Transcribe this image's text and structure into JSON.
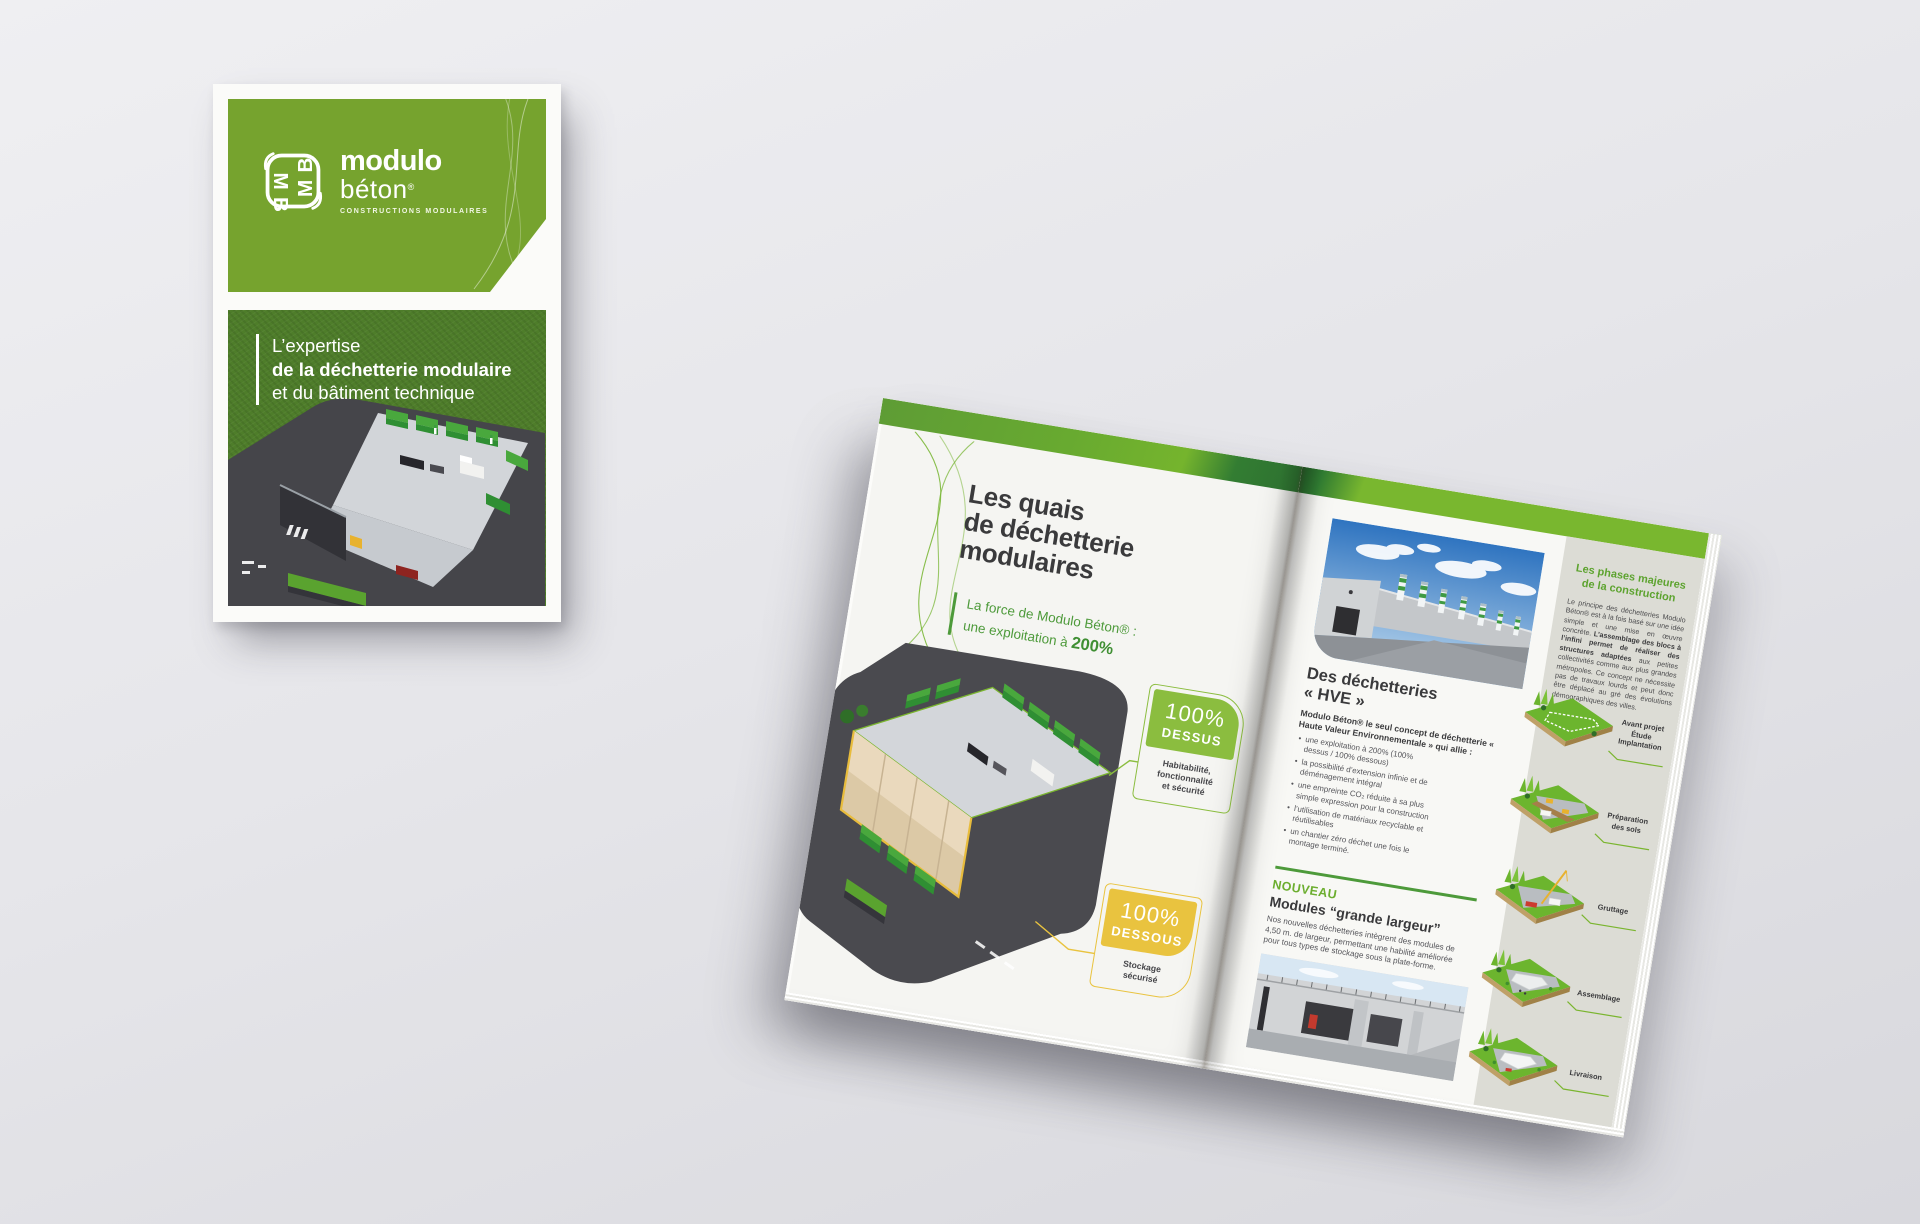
{
  "cover": {
    "logo": {
      "word1": "modulo",
      "word2": "béton",
      "registered": "®",
      "tagline": "CONSTRUCTIONS MODULAIRES"
    },
    "title": {
      "line1": "L’expertise",
      "line2": "de la déchetterie modulaire",
      "line3": "et du bâtiment technique"
    }
  },
  "spread": {
    "left_page": {
      "title": "Les quais\nde déchetterie\nmodulaires",
      "subtitle_line1": "La force de Modulo Béton® :",
      "subtitle_line2_prefix": "une exploitation à ",
      "subtitle_highlight": "200%",
      "callout_dessus": {
        "percent": "100%",
        "label": "DESSUS",
        "caption": "Habitabilité,\nfonctionnalité\net sécurité"
      },
      "callout_dessous": {
        "percent": "100%",
        "label": "DESSOUS",
        "caption": "Stockage\nsécurisé"
      }
    },
    "right_page": {
      "hve": {
        "heading": "Des déchetteries\n« HVE »",
        "intro": "Modulo Béton® le seul concept de déchetterie « Haute Valeur Environnementale » qui allie :",
        "bullets": [
          "une exploitation à 200% (100% dessus / 100% dessous)",
          "la possibilité d’extension infinie et de déménagement intégral",
          "une empreinte CO₂ réduite à sa plus simple expression pour la construction",
          "l’utilisation de matériaux recyclable et réutilisables",
          "un chantier zéro déchet une fois le montage terminé."
        ]
      },
      "nouveau": {
        "kicker": "NOUVEAU",
        "heading": "Modules “grande largeur”",
        "body": "Nos nouvelles déchetteries intègrent des modules de 4,50 m. de largeur, permettant une habilité améliorée pour tous types de stockage sous la plate-forme."
      },
      "sidebar": {
        "heading": "Les phases majeures\nde la construction",
        "body_1": "Le principe des déchetteries Modulo Béton® est à la fois basé sur une idée simple et une mise en œuvre concrète. ",
        "body_2": "L’assemblage des blocs à l’infini permet de réaliser des structures adaptées",
        "body_3": " aux petites collectivités comme aux plus grandes métropoles. Ce concept ne nécessite pas de travaux lourds et peut donc être déplacé au gré des évolutions démographiques des villes.",
        "phases": [
          "Avant projet\nÉtude\nImplantation",
          "Préparation\ndes sols",
          "Gruttage",
          "Assemblage",
          "Livraison"
        ]
      }
    }
  },
  "colors": {
    "brand_green": "#76a32e",
    "bar_green": "#75b42d",
    "dark_green": "#2d7030",
    "accent_green_text": "#4d9a3a",
    "callout_green": "#8bbd3f",
    "callout_yellow": "#e9c33f",
    "text_dark": "#3a3a3c",
    "sidebar_gray": "#dcdcd5"
  }
}
